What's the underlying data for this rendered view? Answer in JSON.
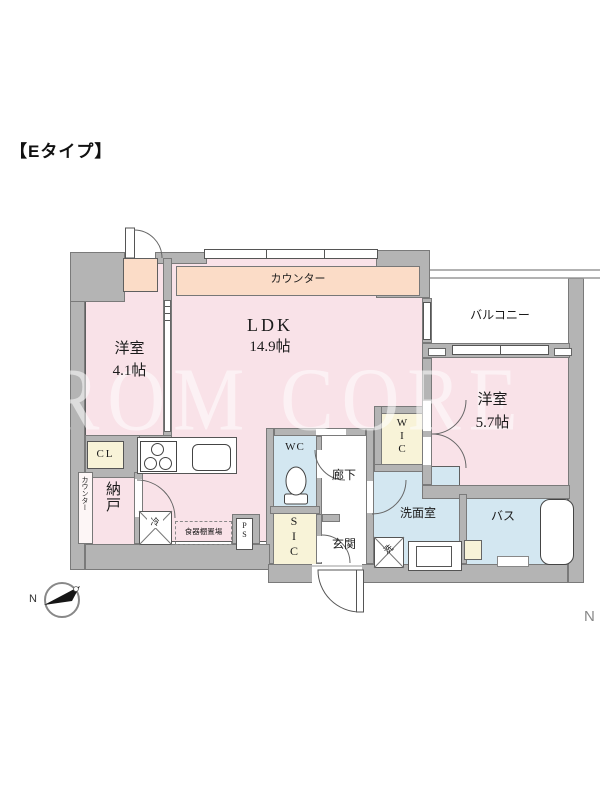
{
  "title": "【Eタイプ】",
  "watermark": "ROM CORE",
  "corner_mark": "N",
  "compass": {
    "label": "N"
  },
  "colors": {
    "room_pink": "#f9e2e8",
    "counter_peach": "#fbdcc7",
    "wet_area_blue": "#d3e7f1",
    "closet_cream": "#f8f3d8",
    "wall_gray": "#b4b4b4",
    "line_dark": "#5f5f5f"
  },
  "rooms": {
    "ldk": {
      "name": "LDK",
      "size": "14.9帖"
    },
    "western1": {
      "name": "洋室",
      "size": "4.1帖"
    },
    "western2": {
      "name": "洋室",
      "size": "5.7帖"
    },
    "balcony": "バルコニー",
    "counter": "カウンター",
    "hallway": "廊下",
    "entrance": "玄関",
    "washroom": "洗面室",
    "bath": "バス",
    "wc": "WC",
    "wic": "WIC",
    "sic": "SIC",
    "cl": "CL",
    "storage": "納戸",
    "storage_counter": "カウンター",
    "ps": "PS"
  },
  "fixtures": {
    "refrigerator": "冷",
    "washer": "洗",
    "dish_shelf": "食器棚置場"
  }
}
